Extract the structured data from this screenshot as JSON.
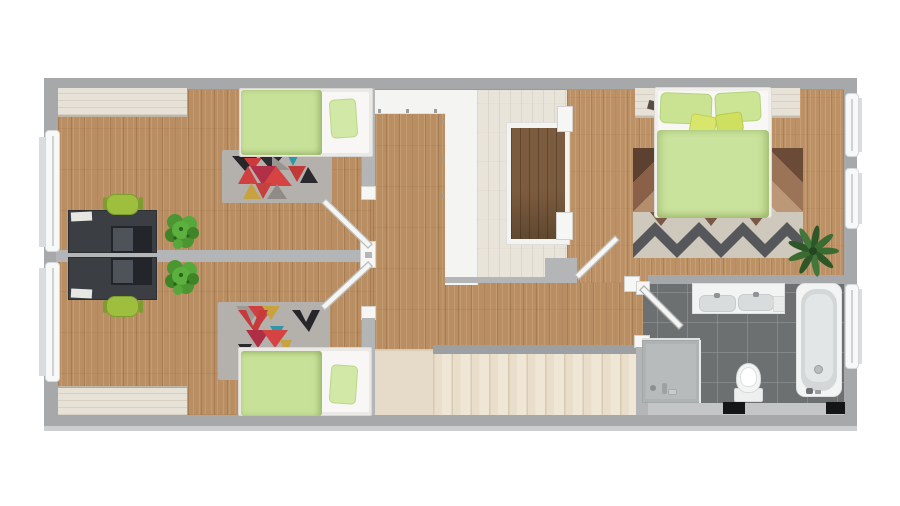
{
  "scene": {
    "kind": "3d-floor-plan-top-view",
    "description": "Rendered upper-floor apartment plan: two children's bedrooms with desks on the left, central hallway with stairwell and staircase, master bedroom top right, bathroom bottom right",
    "text_visible": "none"
  },
  "palette": {
    "background": "#ffffff",
    "outer_wall_gray": "#a6a8aa",
    "inner_wall_gray": "#b3b5b7",
    "white_trim": "#f6f6f4",
    "oak_floor": "#b98e62",
    "master_oak_floor": "#bd9166",
    "whitewashed_wood": "#e9e4da",
    "stairwell_dark_wood": "#7c5c3e",
    "stair_beige": "#e9decb",
    "bathroom_tile": "#6d7071",
    "duvet_green": "#c7e199",
    "pillow_green": "#d2e8a6",
    "accent_yellow_pillow": "#d9e66c",
    "chair_green": "#9dbf3d",
    "desk_charcoal": "#3b3f43",
    "plant_green": "#57a83a",
    "master_plant_green": "#3a6b31",
    "rug_gray_base": "#b4b1ad",
    "rug_red": "#d04040",
    "rug_crimson": "#b13048",
    "rug_teal": "#2f97a6",
    "rug_mustard": "#c8a23e",
    "rug_black": "#26262a",
    "master_rug_cream": "#d7cdbf",
    "master_rug_brown": "#8a6148",
    "master_rug_dark_zigzag": "#55575b",
    "mat_black": "#141517"
  },
  "rooms": [
    {
      "name": "bedroom-top-left",
      "floor": "oak",
      "furniture": [
        "wardrobe-strip",
        "single-bed",
        "triangle-rug",
        "desk-with-laptop",
        "office-chair",
        "potted-plant"
      ]
    },
    {
      "name": "bedroom-bottom-left",
      "floor": "oak",
      "furniture": [
        "wardrobe-strip",
        "single-bed",
        "triangle-rug",
        "desk-with-laptop",
        "office-chair",
        "potted-plant"
      ]
    },
    {
      "name": "hallway-landing",
      "floor": "oak-and-whitewash",
      "features": [
        "stairwell-void",
        "staircase-down",
        "white-partition"
      ]
    },
    {
      "name": "master-bedroom",
      "floor": "oak",
      "furniture": [
        "headboard-wardrobe-strip",
        "double-bed",
        "chevron-rug",
        "potted-plant"
      ]
    },
    {
      "name": "bathroom",
      "floor": "dark-tile",
      "fixtures": [
        "double-sink-vanity",
        "bathtub",
        "toilet",
        "shower-tray",
        "two-black-mats"
      ]
    }
  ],
  "openings": {
    "windows_left_wall": 2,
    "windows_right_wall": 3,
    "interior_doors_open_at_45deg": 4
  },
  "staircase": {
    "visible_steps": 11,
    "orientation": "horizontal",
    "landing": "bottom-left-of-stairs"
  }
}
